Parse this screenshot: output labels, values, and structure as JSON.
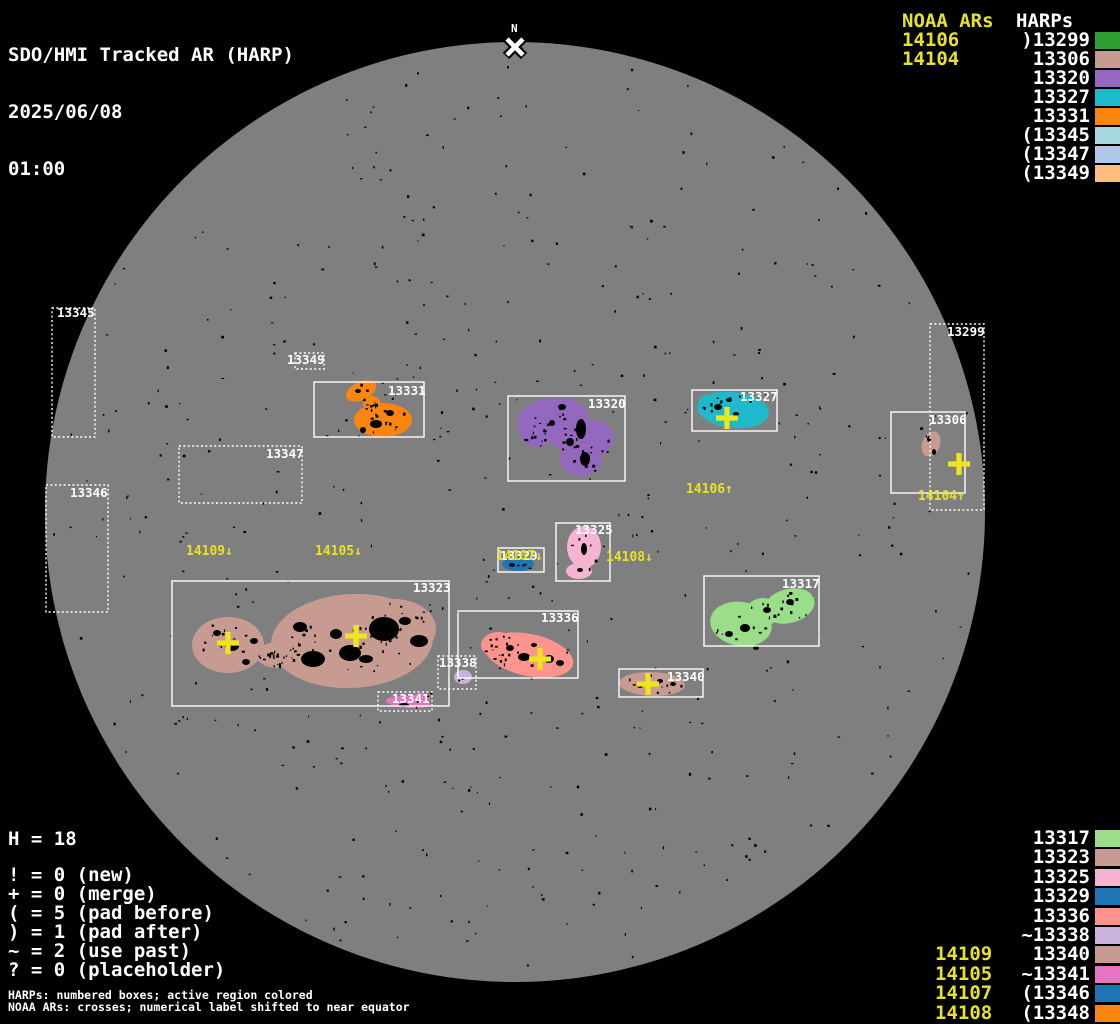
{
  "header": {
    "title": "SDO/HMI Tracked AR (HARP)",
    "date": "2025/06/08",
    "time": "01:00"
  },
  "colors": {
    "background": "#000000",
    "disk_gray": "#7F7F7F",
    "text_white": "#FFFFFF",
    "noaa_yellow": "#E8E224"
  },
  "top_right_legend": {
    "noaa_header": "NOAA ARs",
    "harps_header": "HARPs",
    "rows": [
      {
        "noaa": "14106",
        "harp": ")13299",
        "color": "#2F9E33"
      },
      {
        "noaa": "14104",
        "harp": "13306",
        "color": "#C79B92"
      },
      {
        "noaa": "",
        "harp": "13320",
        "color": "#9468BE"
      },
      {
        "noaa": "",
        "harp": "13327",
        "color": "#1FB9CC"
      },
      {
        "noaa": "",
        "harp": "13331",
        "color": "#FB8511"
      },
      {
        "noaa": "",
        "harp": "(13345",
        "color": "#A8D9E2"
      },
      {
        "noaa": "",
        "harp": "(13347",
        "color": "#AFC7E8"
      },
      {
        "noaa": "",
        "harp": "(13349",
        "color": "#FFBE7D"
      }
    ]
  },
  "bottom_right_legend": {
    "rows": [
      {
        "noaa": "",
        "harp": "13317",
        "color": "#9ADE89"
      },
      {
        "noaa": "",
        "harp": "13323",
        "color": "#C79B92"
      },
      {
        "noaa": "",
        "harp": "13325",
        "color": "#F5B5D2"
      },
      {
        "noaa": "",
        "harp": "13329",
        "color": "#1F74B4"
      },
      {
        "noaa": "",
        "harp": "13336",
        "color": "#FF948F"
      },
      {
        "noaa": "",
        "harp": "~13338",
        "color": "#C9B3DC"
      },
      {
        "noaa": "14109",
        "harp": "13340",
        "color": "#C79B92"
      },
      {
        "noaa": "14105",
        "harp": "~13341",
        "color": "#E574C3"
      },
      {
        "noaa": "14107",
        "harp": "(13346",
        "color": "#1F74B4"
      },
      {
        "noaa": "14108",
        "harp": "(13348",
        "color": "#FB8511"
      }
    ]
  },
  "bottom_left_legend": {
    "h_line": "H = 18",
    "lines": [
      "! = 0 (new)",
      "+ = 0 (merge)",
      "( = 5 (pad before)",
      ") = 1 (pad after)",
      "~ = 2 (use past)",
      "? = 0 (placeholder)"
    ],
    "footnotes": [
      "HARPs: numbered boxes; active region colored",
      "NOAA ARs: crosses; numerical label shifted to near equator"
    ]
  },
  "chart_data": {
    "type": "scatter",
    "title": "SDO/HMI Tracked AR (HARP)",
    "timestamp": "2025/06/08 01:00",
    "disk": {
      "cx": 515,
      "cy": 512,
      "r": 470,
      "color": "#7F7F7F"
    },
    "speckle_count": 480,
    "cross_color": "#F0E41E",
    "label_color": "#E8E224",
    "north_marker": {
      "label": "N",
      "x": 515,
      "label_y": 32,
      "cross_y": 47
    },
    "harps": [
      {
        "id": "13299",
        "box": [
          930,
          324,
          54,
          186
        ],
        "style": "dotted",
        "label_xy": [
          947,
          326
        ],
        "color": "#2F9E33",
        "blob": [],
        "patches": [],
        "speckles": 0
      },
      {
        "id": "13306",
        "box": [
          891,
          412,
          74,
          81
        ],
        "style": "solid",
        "label_xy": [
          929,
          414
        ],
        "color": "#C79B92",
        "blob": [
          [
            931,
            444,
            9,
            13,
            20
          ]
        ],
        "patches": [
          [
            929,
            439,
            2,
            3
          ],
          [
            934,
            452,
            2,
            3
          ]
        ],
        "speckles": 2
      },
      {
        "id": "13320",
        "box": [
          508,
          396,
          117,
          85
        ],
        "style": "solid",
        "label_xy": [
          588,
          398
        ],
        "color": "#9468BE",
        "blob": [
          [
            553,
            420,
            36,
            22,
            -5
          ],
          [
            537,
            432,
            17,
            15,
            0
          ],
          [
            593,
            438,
            21,
            18,
            0
          ],
          [
            581,
            459,
            21,
            17,
            0
          ],
          [
            567,
            438,
            15,
            13,
            0
          ]
        ],
        "patches": [
          [
            581,
            429,
            5,
            10
          ],
          [
            562,
            407,
            4,
            3
          ],
          [
            585,
            459,
            5,
            7
          ],
          [
            552,
            423,
            3,
            3
          ],
          [
            570,
            442,
            4,
            4
          ]
        ],
        "speckles": 45
      },
      {
        "id": "13327",
        "box": [
          692,
          390,
          85,
          41
        ],
        "style": "solid",
        "label_xy": [
          740,
          391
        ],
        "color": "#1FB9CC",
        "blob": [
          [
            733,
            410,
            36,
            18,
            6
          ],
          [
            711,
            404,
            13,
            10,
            0
          ]
        ],
        "patches": [
          [
            718,
            407,
            4,
            3
          ],
          [
            736,
            414,
            3,
            2
          ],
          [
            729,
            400,
            3,
            2
          ]
        ],
        "speckles": 10
      },
      {
        "id": "13331",
        "box": [
          314,
          382,
          110,
          55
        ],
        "style": "solid",
        "label_xy": [
          388,
          385
        ],
        "color": "#FB8511",
        "blob": [
          [
            383,
            420,
            29,
            17,
            0
          ],
          [
            361,
            391,
            16,
            9,
            -25
          ],
          [
            372,
            404,
            9,
            8,
            20
          ]
        ],
        "patches": [
          [
            376,
            424,
            6,
            4
          ],
          [
            390,
            413,
            4,
            3
          ],
          [
            363,
            430,
            3,
            3
          ],
          [
            358,
            391,
            3,
            2
          ]
        ],
        "speckles": 22
      },
      {
        "id": "13345",
        "box": [
          52,
          308,
          43,
          129
        ],
        "style": "dotted",
        "label_xy": [
          57,
          307
        ],
        "color": "#A8D9E2",
        "blob": [],
        "patches": [],
        "speckles": 0
      },
      {
        "id": "13346",
        "box": [
          46,
          485,
          62,
          127
        ],
        "style": "dotted",
        "label_xy": [
          70,
          487
        ],
        "color": "#1F74B4",
        "blob": [],
        "patches": [],
        "speckles": 0
      },
      {
        "id": "13347",
        "box": [
          179,
          446,
          123,
          57
        ],
        "style": "dotted",
        "label_xy": [
          266,
          448
        ],
        "color": "#AFC7E8",
        "blob": [],
        "patches": [],
        "speckles": 0
      },
      {
        "id": "13349",
        "box": [
          295,
          353,
          29,
          16
        ],
        "style": "dotted",
        "label_xy": [
          287,
          354
        ],
        "color": "#FFBE7D",
        "blob": [],
        "patches": [],
        "speckles": 0
      },
      {
        "id": "13323",
        "box": [
          172,
          581,
          277,
          125
        ],
        "style": "solid",
        "label_xy": [
          413,
          582
        ],
        "color": "#C79B92",
        "blob": [
          [
            228,
            645,
            36,
            28,
            0
          ],
          [
            278,
            655,
            22,
            13,
            0
          ],
          [
            352,
            641,
            81,
            47,
            -3
          ],
          [
            394,
            629,
            42,
            30,
            0
          ],
          [
            305,
            645,
            28,
            20,
            0
          ]
        ],
        "patches": [
          [
            384,
            629,
            15,
            12
          ],
          [
            350,
            653,
            11,
            8
          ],
          [
            313,
            659,
            12,
            8
          ],
          [
            419,
            641,
            9,
            6
          ],
          [
            300,
            627,
            7,
            5
          ],
          [
            336,
            634,
            6,
            5
          ],
          [
            366,
            659,
            7,
            4
          ],
          [
            405,
            621,
            6,
            4
          ],
          [
            232,
            646,
            7,
            5
          ],
          [
            254,
            641,
            4,
            3
          ],
          [
            217,
            633,
            4,
            3
          ],
          [
            246,
            662,
            4,
            3
          ]
        ],
        "speckles": 90
      },
      {
        "id": "13325",
        "box": [
          556,
          523,
          54,
          58
        ],
        "style": "solid",
        "label_xy": [
          575,
          524
        ],
        "color": "#F5B5D2",
        "blob": [
          [
            584,
            547,
            17,
            21,
            0
          ],
          [
            579,
            571,
            13,
            8,
            0
          ]
        ],
        "patches": [
          [
            584,
            549,
            3,
            6
          ],
          [
            580,
            570,
            3,
            2
          ]
        ],
        "speckles": 6
      },
      {
        "id": "13329",
        "box": [
          498,
          548,
          46,
          24
        ],
        "style": "solid",
        "label_xy": [
          500,
          550
        ],
        "color": "#1F74B4",
        "blob": [
          [
            518,
            564,
            16,
            7,
            0
          ]
        ],
        "patches": [
          [
            512,
            565,
            3,
            2
          ]
        ],
        "speckles": 4
      },
      {
        "id": "13336",
        "box": [
          458,
          611,
          120,
          67
        ],
        "style": "solid",
        "label_xy": [
          541,
          612
        ],
        "color": "#FF948F",
        "blob": [
          [
            529,
            655,
            45,
            21,
            12
          ],
          [
            498,
            645,
            17,
            13,
            0
          ]
        ],
        "patches": [
          [
            524,
            657,
            6,
            4
          ],
          [
            549,
            659,
            5,
            4
          ],
          [
            510,
            648,
            4,
            3
          ],
          [
            534,
            645,
            3,
            2
          ],
          [
            560,
            663,
            4,
            3
          ]
        ],
        "speckles": 22
      },
      {
        "id": "13338",
        "box": [
          438,
          656,
          38,
          33
        ],
        "style": "dotted",
        "label_xy": [
          439,
          657
        ],
        "color": "#C9B3DC",
        "blob": [
          [
            463,
            677,
            9,
            7,
            0
          ]
        ],
        "patches": [],
        "speckles": 2
      },
      {
        "id": "13340",
        "box": [
          619,
          669,
          84,
          28
        ],
        "style": "solid",
        "label_xy": [
          667,
          671
        ],
        "color": "#C79B92",
        "blob": [
          [
            652,
            684,
            33,
            12,
            2
          ]
        ],
        "patches": [
          [
            640,
            686,
            3,
            2
          ],
          [
            660,
            681,
            3,
            2
          ],
          [
            673,
            684,
            3,
            2
          ]
        ],
        "speckles": 10
      },
      {
        "id": "13341",
        "box": [
          378,
          692,
          54,
          19
        ],
        "style": "dotted",
        "label_xy": [
          392,
          693
        ],
        "color": "#E574C3",
        "blob": [
          [
            408,
            702,
            22,
            6,
            4
          ],
          [
            421,
            698,
            8,
            5,
            0
          ]
        ],
        "patches": [
          [
            404,
            705,
            5,
            2
          ]
        ],
        "speckles": 3
      },
      {
        "id": "13317",
        "box": [
          704,
          576,
          115,
          70
        ],
        "style": "solid",
        "label_xy": [
          782,
          578
        ],
        "color": "#9ADE89",
        "blob": [
          [
            741,
            624,
            31,
            22,
            10
          ],
          [
            789,
            606,
            26,
            17,
            -15
          ],
          [
            763,
            612,
            17,
            14,
            0
          ]
        ],
        "patches": [
          [
            745,
            628,
            5,
            4
          ],
          [
            729,
            634,
            4,
            3
          ],
          [
            767,
            610,
            4,
            3
          ],
          [
            790,
            602,
            4,
            3
          ],
          [
            756,
            648,
            3,
            2
          ]
        ],
        "speckles": 25
      }
    ],
    "noaa_crosses": [
      [
        727,
        418
      ],
      [
        959,
        464
      ],
      [
        228,
        643
      ],
      [
        356,
        636
      ],
      [
        540,
        659
      ],
      [
        648,
        684
      ]
    ],
    "noaa_disk_labels": [
      {
        "text": "14109↓",
        "x": 186,
        "y": 545
      },
      {
        "text": "14105↓",
        "x": 315,
        "y": 545
      },
      {
        "text": "14106↑",
        "x": 686,
        "y": 483
      },
      {
        "text": "14108↓",
        "x": 606,
        "y": 551
      },
      {
        "text": "14107↓",
        "x": 496,
        "y": 550
      },
      {
        "text": "14104↑",
        "x": 918,
        "y": 490
      }
    ]
  }
}
